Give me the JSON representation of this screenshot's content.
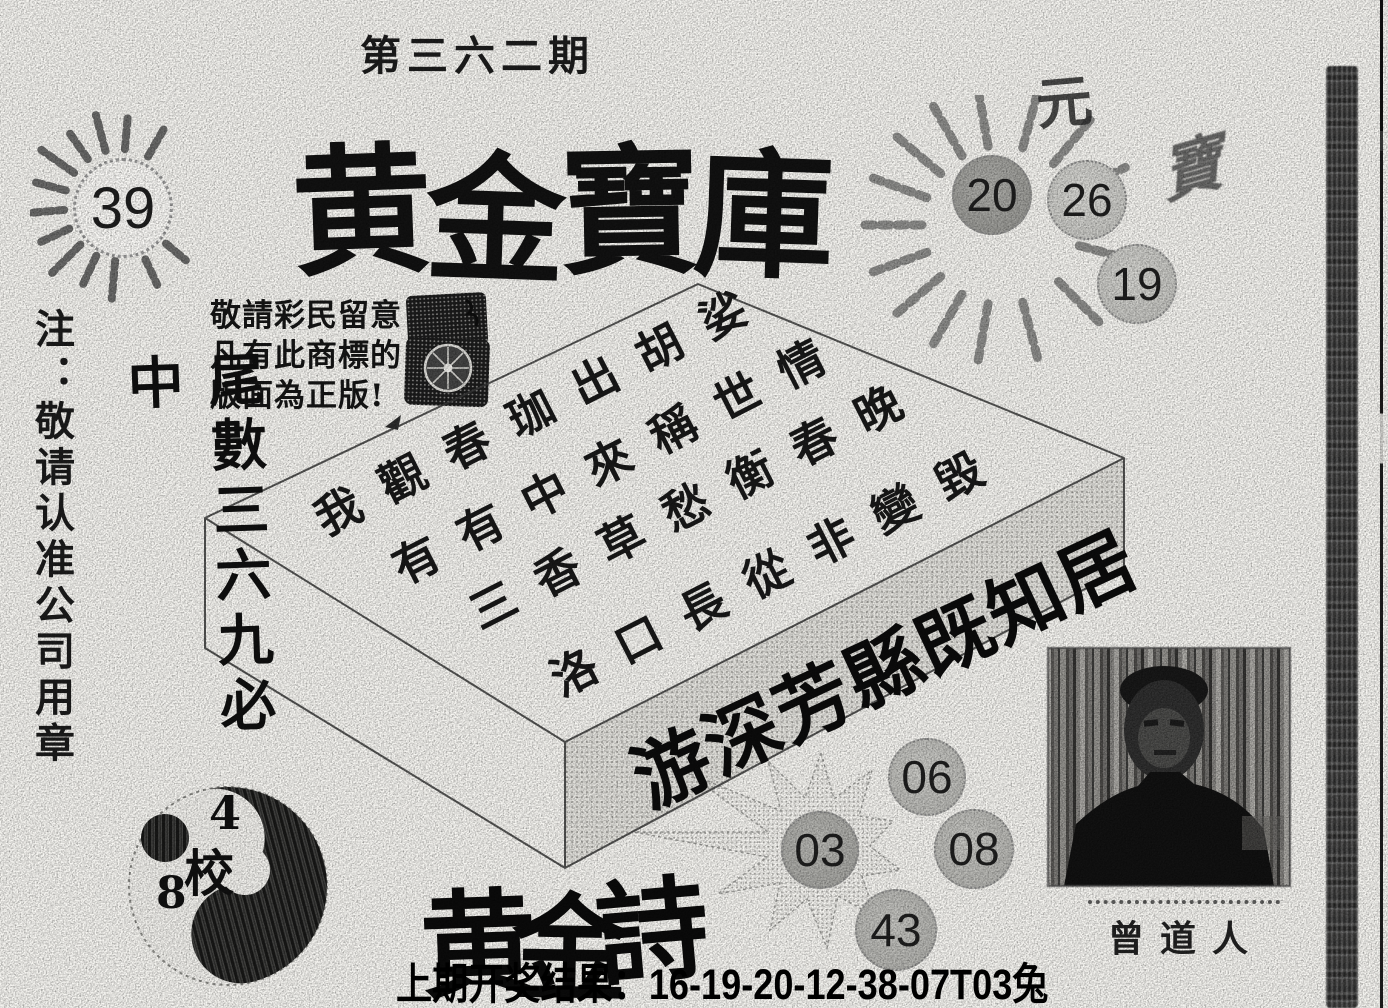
{
  "issue_title": "第三六二期",
  "main_title": [
    "黄",
    "金",
    "寶",
    "庫"
  ],
  "sun_left": {
    "number": "39"
  },
  "sun_right": {
    "char_top": "元",
    "char_side": "寶",
    "circles": [
      "20",
      "26",
      "19"
    ]
  },
  "notice_lines": [
    "敬請彩民留意",
    "凡有此商標的",
    "版面為正版!"
  ],
  "note_column": "注：敬请认准公司用章",
  "tail_column": "尾數三六九必中",
  "box_top_rows": [
    "我觀春珈出胡娑",
    "有有中來稱世情",
    "三香草愁衡春晚",
    "洛口長從非變毀"
  ],
  "box_front_text": "游深芳縣既知居",
  "poem_title": [
    "黄",
    "金",
    "詩"
  ],
  "picks": {
    "star": "03",
    "c1": "06",
    "c2": "08",
    "c3": "43"
  },
  "taiji": {
    "top": "4",
    "center": "校",
    "bottom": "8"
  },
  "portrait_caption": "曾道人",
  "footer_result": "上期开奖结果：16-19-20-12-38-07T03兔",
  "colors": {
    "ink": "#1a1a1a",
    "paper": "#f7f6f2",
    "halftone_dark": "#9e9e9a",
    "halftone_light": "#d6d6d2"
  }
}
